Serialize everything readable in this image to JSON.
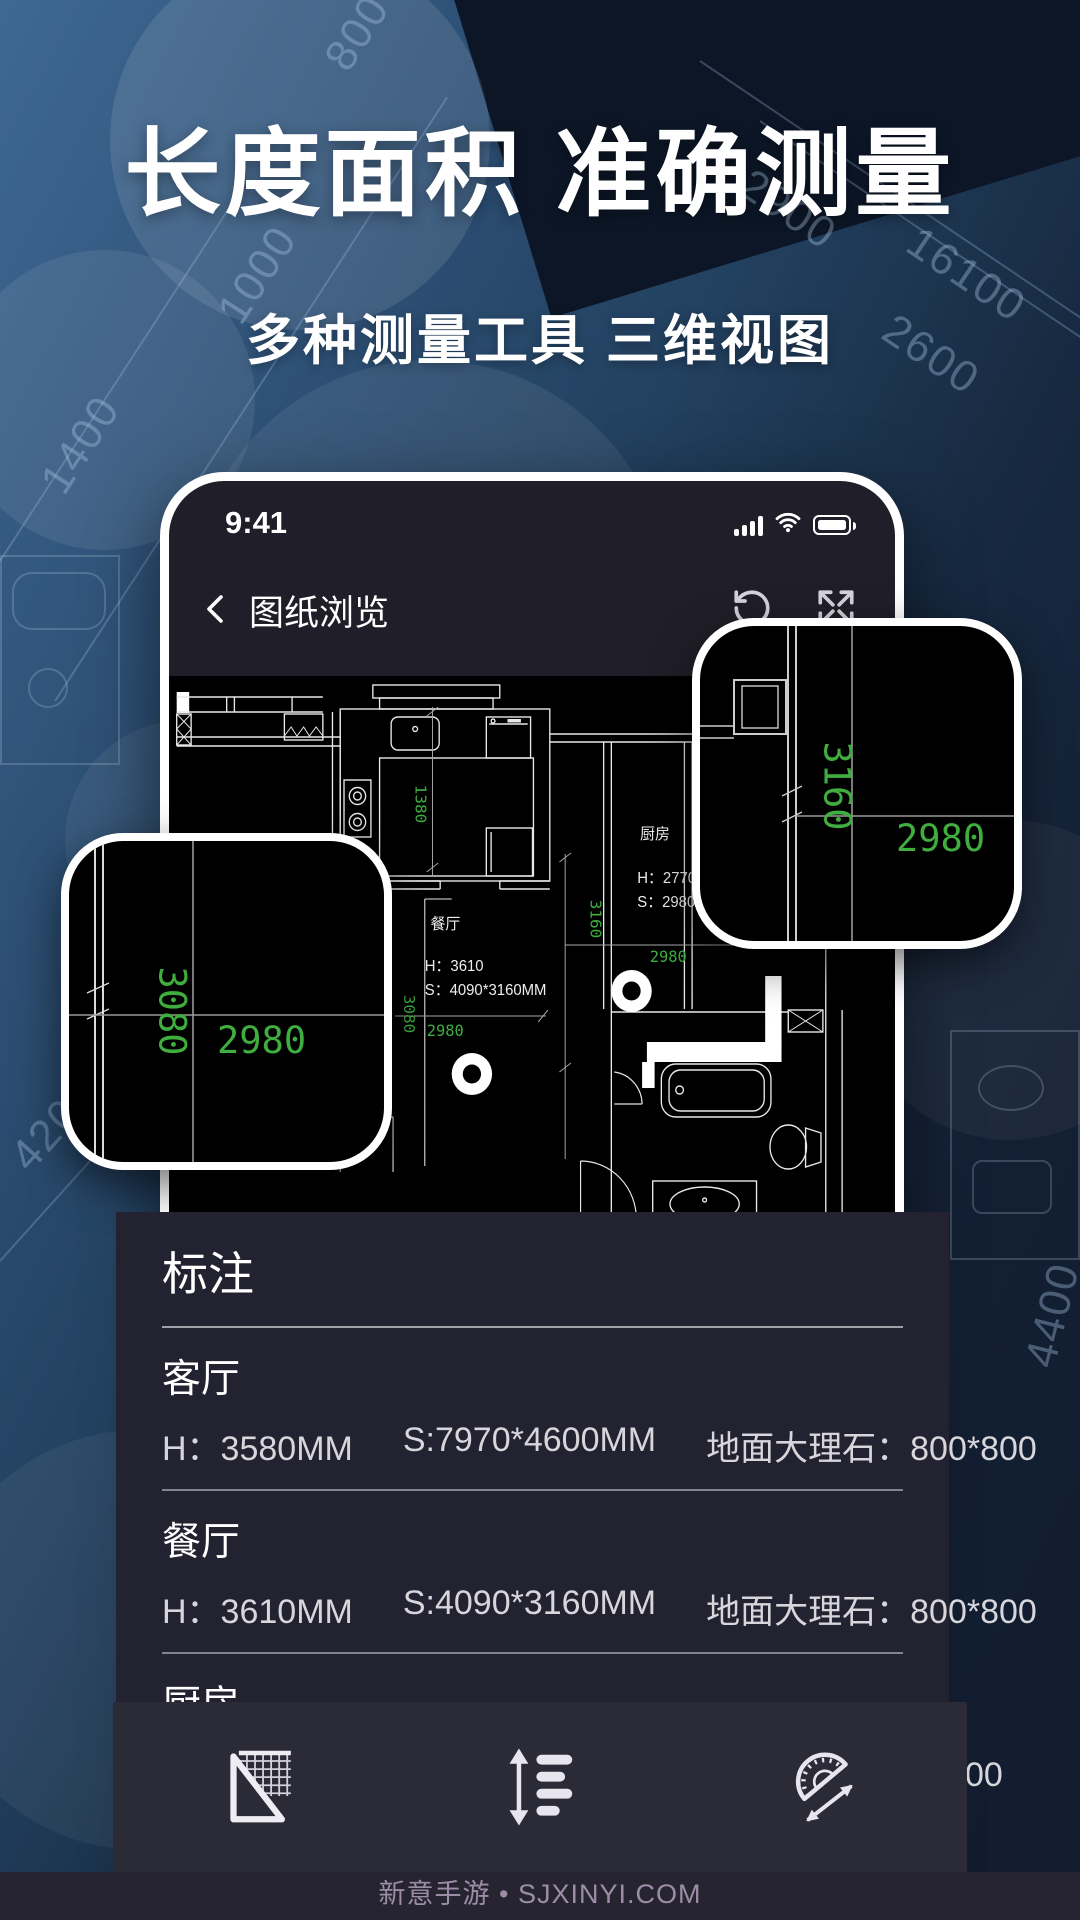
{
  "hero": {
    "title": "长度面积 准确测量",
    "subtitle": "多种测量工具 三维视图"
  },
  "background": {
    "dim_labels": [
      "1400",
      "1000",
      "800",
      "2900",
      "16100",
      "2600",
      "4200",
      "4400"
    ]
  },
  "phone": {
    "status": {
      "time": "9:41"
    },
    "nav": {
      "title": "图纸浏览"
    },
    "floorplan": {
      "kitchen_dim": "1380",
      "hall_v_dim": "3160",
      "hall_h_dim": "2980",
      "dining_v_dim": "3080",
      "dining_h_dim": "2980",
      "rooms": {
        "kitchen": {
          "name": "厨房",
          "h": "H：2770",
          "s": "S：2980*3160MM"
        },
        "dining": {
          "name": "餐厅",
          "h": "H：3610",
          "s": "S：4090*3160MM"
        }
      }
    }
  },
  "callouts": {
    "left": {
      "v_dim": "3080",
      "h_dim": "2980"
    },
    "right": {
      "v_dim": "3160",
      "h_dim": "2980"
    }
  },
  "panel": {
    "title": "标注",
    "rows": [
      {
        "name": "客厅",
        "height": "H：3580MM",
        "size": "S:7970*4600MM",
        "floor": "地面大理石：800*800"
      },
      {
        "name": "餐厅",
        "height": "H：3610MM",
        "size": "S:4090*3160MM",
        "floor": "地面大理石：800*800"
      },
      {
        "name": "厨房",
        "height": "H：2770MM",
        "size": "S:2980*3160MM",
        "floor": "地面地砖：600*600"
      }
    ]
  },
  "toolbar": {
    "icons": [
      "ruler-grid",
      "line-spacing",
      "protractor"
    ]
  },
  "footer": {
    "text": "新意手游 • SJXINYI.COM"
  },
  "colors": {
    "accent_green": "#3fae3f",
    "panel_bg": "#232231",
    "toolbar_bg": "#2b2a37",
    "phone_bg": "#201f29",
    "frame": "#ffffff"
  }
}
